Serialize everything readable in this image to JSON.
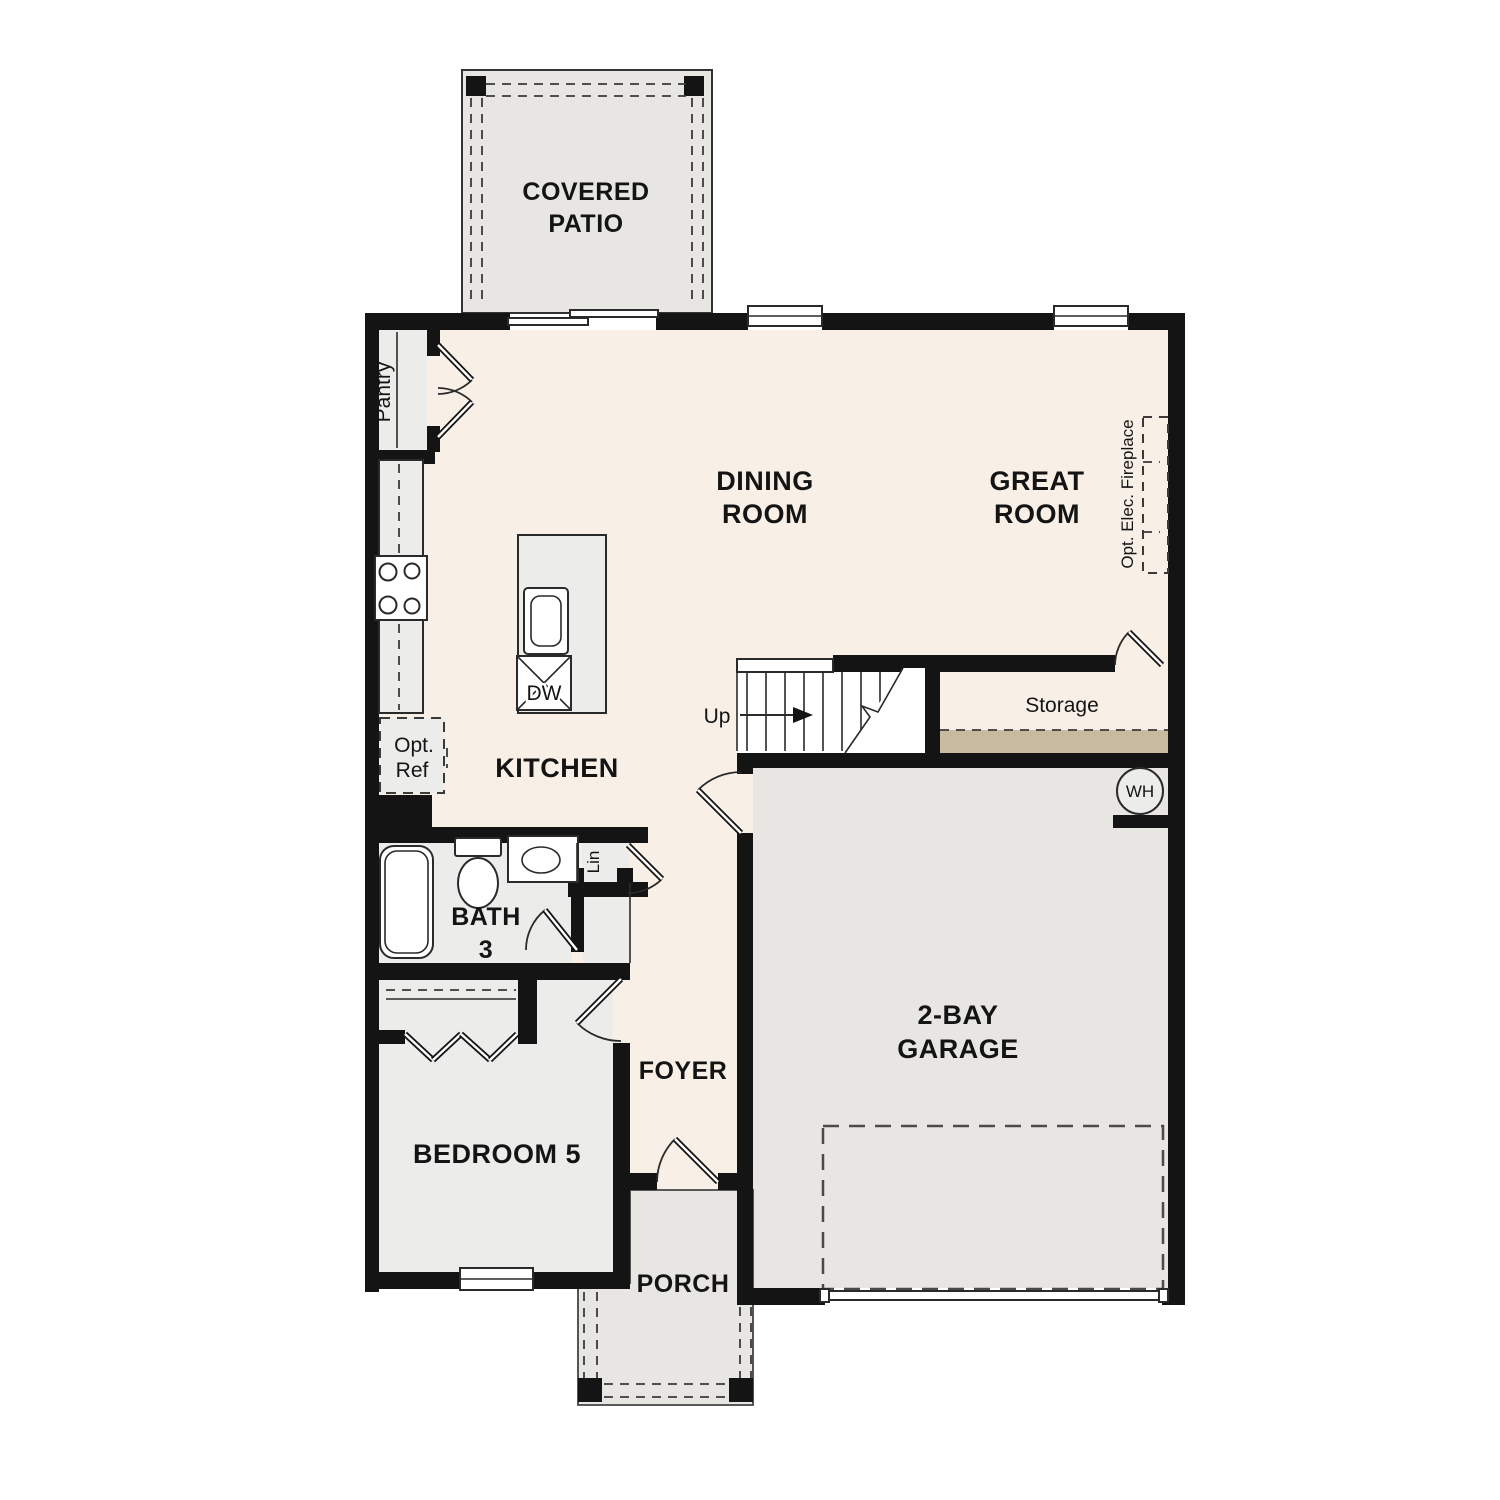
{
  "colors": {
    "wall": "#141414",
    "cream": "#f8f0e7",
    "gray": "#e7e6e3",
    "gray2": "#ececea",
    "tan": "#c9bba1",
    "line": "#2a2a2a"
  },
  "rooms": {
    "covered_patio": {
      "line1": "COVERED",
      "line2": "PATIO"
    },
    "dining_room": {
      "line1": "DINING",
      "line2": "ROOM"
    },
    "great_room": {
      "line1": "GREAT",
      "line2": "ROOM"
    },
    "kitchen": {
      "label": "KITCHEN"
    },
    "bath_3": {
      "line1": "BATH",
      "line2": "3"
    },
    "bedroom_5": {
      "label": "BEDROOM 5"
    },
    "foyer": {
      "label": "FOYER"
    },
    "porch": {
      "label": "PORCH"
    },
    "garage": {
      "line1": "2-BAY",
      "line2": "GARAGE"
    },
    "storage": {
      "label": "Storage"
    }
  },
  "annotations": {
    "pantry": "Pantry",
    "opt_ref": {
      "line1": "Opt.",
      "line2": "Ref"
    },
    "dishwasher": "DW",
    "linen": "Lin",
    "water_heater": "WH",
    "stairs_up": "Up",
    "opt_elec_fireplace": "Opt. Elec. Fireplace"
  }
}
